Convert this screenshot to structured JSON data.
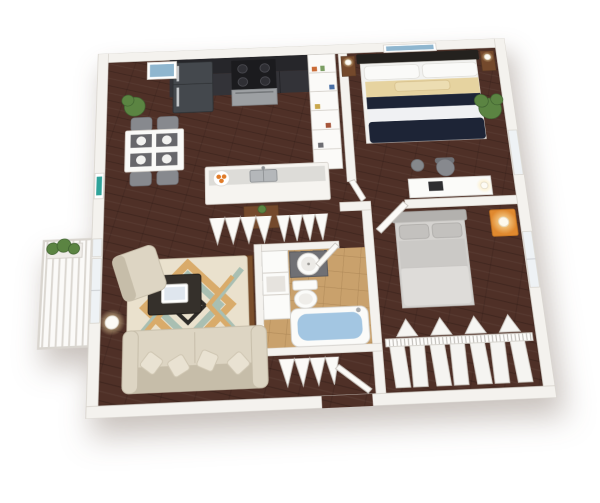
{
  "scene": {
    "title": "3D apartment floor plan render",
    "view": "isometric top-down, one-bedroom-plus-den unit, no text labels",
    "background": "#ffffff"
  },
  "colors": {
    "wall": "#f4f2ee",
    "wallEdge": "#d7d3cc",
    "floorWood": "#4f3027",
    "floorTile": "#c9a16c",
    "cabinetUpper": "#26262a",
    "cabinetLower": "#333338",
    "applianceDark": "#44484d",
    "stoveBlack": "#1b1b1e",
    "stainless": "#9da0a3",
    "counterTop": "#dddcd8",
    "counterFace": "#f6f4f0",
    "sinkSteel": "#b4b7ba",
    "fruitOrange": "#e07b28",
    "tableWhite": "#fafaf8",
    "placematGray": "#67676b",
    "chairGray": "#87898e",
    "headboardDark": "#24211e",
    "beddingNavy": "#1d2436",
    "beddingWhite": "#f0f1f3",
    "beddingTan": "#e6d3a0",
    "nightstandWood": "#74492c",
    "bed2Frame": "#b3b1ae",
    "bed2Blanket": "#cbc9c6",
    "bed2Foot": "#dedcd9",
    "orangeStand": "#e0892f",
    "lampGlow": "#ffe9b0",
    "plantGreen": "#5b8442",
    "plantDark": "#3f6130",
    "rugBase": "#eae1cd",
    "rugSage": "#a9bfb2",
    "rugTan": "#d9ab6a",
    "rugBlack": "#2e2b28",
    "sofaBeige": "#ddd5c3",
    "sofaShade": "#c6bda9",
    "coffeeTable": "#35302b",
    "tabletScreen": "#dfe6ee",
    "tvStandWood": "#7a4e2b",
    "tvBlack": "#161616",
    "tubWater": "#a3c6e2",
    "porcelain": "#fbfbf9",
    "doorWhite": "#fbfaf7",
    "hangerLine": "#b7b4af",
    "windowGlass": "#eef2f5",
    "artTeal": "#2fa39a",
    "artBeach": "#8fb6cf",
    "garmentWhite": "#f5f4f1"
  },
  "rooms": [
    {
      "id": "kitchen",
      "name": "Kitchen",
      "furniture": [
        "dark upper and lower cabinets",
        "stainless refrigerator",
        "range with oven",
        "wire pantry shelving",
        "peninsula counter with sink",
        "bowl of oranges",
        "small wood cabinet with plant"
      ]
    },
    {
      "id": "dining",
      "name": "Dining Area",
      "furniture": [
        "white dining table",
        "four gray chairs",
        "four placemats with plates",
        "potted plant",
        "beach wall art",
        "teal wall art"
      ]
    },
    {
      "id": "bedroom1",
      "name": "Bedroom 1",
      "furniture": [
        "bed with navy and white striped bedding",
        "dark headboard",
        "two wood nightstands with lamps",
        "desk with lamp",
        "desk chair",
        "waste basket",
        "corner plant",
        "beach picture above bed"
      ]
    },
    {
      "id": "bedroom2",
      "name": "Bedroom 2",
      "furniture": [
        "gray upholstered bed",
        "orange nightstand with lit lamp",
        "open closet with hanging clothes",
        "window",
        "hinged door"
      ]
    },
    {
      "id": "bathroom",
      "name": "Bathroom",
      "furniture": [
        "round vessel sink on dark vanity",
        "toilet",
        "bathtub filled with water",
        "white linen shelving",
        "tan tile floor",
        "hinged door"
      ]
    },
    {
      "id": "living",
      "name": "Living Room",
      "furniture": [
        "beige sofa with pillows",
        "beige armchair",
        "dark coffee table with tablet",
        "geometric area rug",
        "tv stand with flat tv",
        "glowing floor lamp",
        "window"
      ]
    },
    {
      "id": "hall",
      "name": "Hall / Entry",
      "furniture": [
        "two bifold hall closets",
        "bifold entry coat closet",
        "entry door"
      ]
    },
    {
      "id": "balcony",
      "name": "Balcony",
      "furniture": [
        "slat railing",
        "planter box with greenery"
      ]
    }
  ]
}
